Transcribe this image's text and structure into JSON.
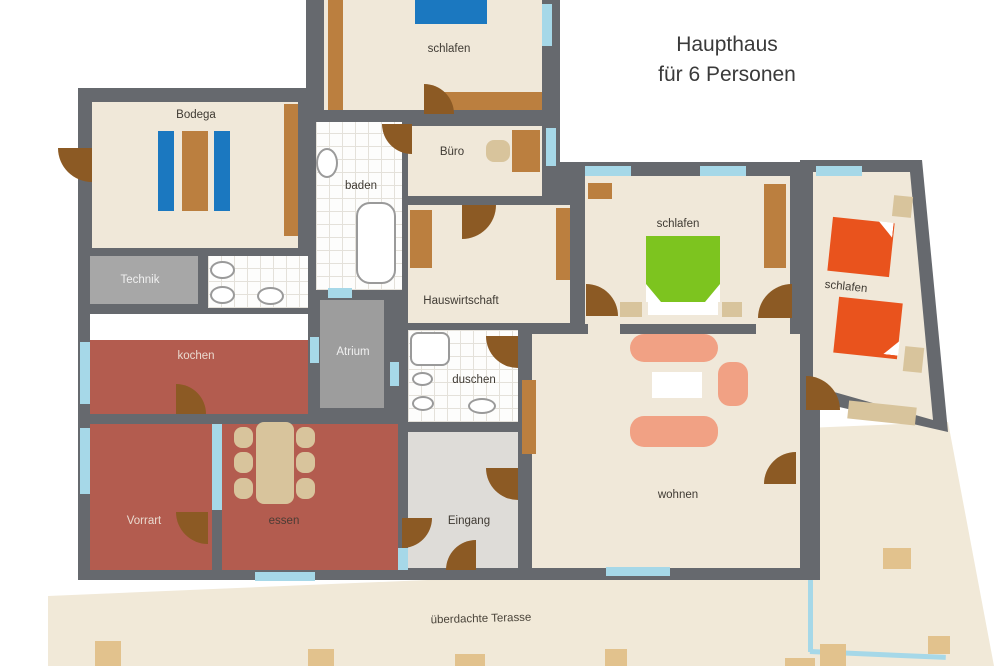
{
  "title": {
    "line1": "Haupthaus",
    "line2": "für 6 Personen"
  },
  "rooms": {
    "bodega": {
      "label": "Bodega"
    },
    "schlafen_oben": {
      "label": "schlafen"
    },
    "buero": {
      "label": "Büro"
    },
    "baden": {
      "label": "baden"
    },
    "technik": {
      "label": "Technik"
    },
    "hauswirtschaft": {
      "label": "Hauswirtschaft"
    },
    "kochen": {
      "label": "kochen"
    },
    "atrium": {
      "label": "Atrium"
    },
    "duschen": {
      "label": "duschen"
    },
    "schlafen_mitte": {
      "label": "schlafen"
    },
    "schlafen_rechts": {
      "label": "schlafen"
    },
    "wohnen": {
      "label": "wohnen"
    },
    "eingang": {
      "label": "Eingang"
    },
    "vorrat": {
      "label": "Vorrart"
    },
    "essen": {
      "label": "essen"
    },
    "terrasse": {
      "label": "überdachte Terasse"
    }
  },
  "colors": {
    "wall": "#66696e",
    "floor": "#f0e8d9",
    "red": "#b35c4f",
    "grayroom": "#a7a7a7",
    "eingangfloor": "#dedcd8",
    "terrace": "#f1e9d8",
    "paver": "#e2c28d",
    "window": "#a6d8e8",
    "wood": "#bb7f3f",
    "door": "#8c5a24",
    "tan": "#d8c49c",
    "bedBlue": "#1b78c0",
    "bedGreen": "#7dc41f",
    "bedOrange": "#e9531d",
    "sofa": "#f1a184"
  }
}
